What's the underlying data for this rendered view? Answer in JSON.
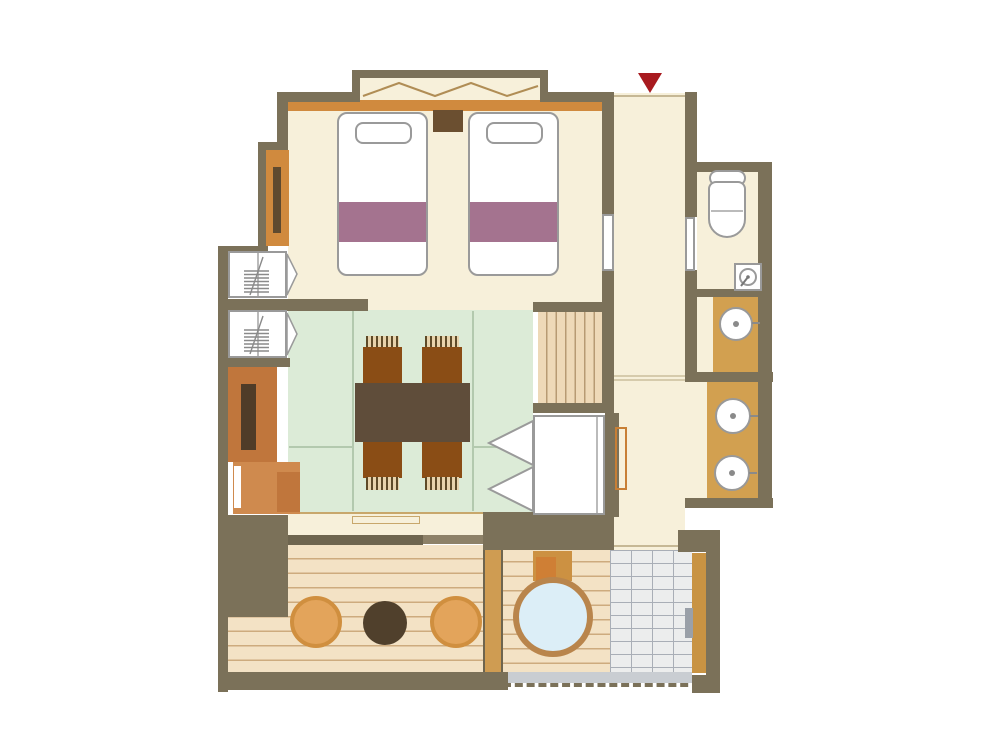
{
  "document": {
    "type": "floor-plan",
    "description": "Japanese-style hotel guest room floor plan with twin beds, tatami dining area, closets, toilet, vanities, changing area, wooden veranda and open-air round bath",
    "visible_text": []
  },
  "entrance_marker": {
    "shape": "downward-triangle",
    "color": "#a81a1f",
    "meaning": "entrance"
  },
  "rooms": [
    {
      "name": "bedroom",
      "floor": "cream",
      "contents": [
        "twin-bed-left",
        "twin-bed-right",
        "nightstand",
        "bay-window",
        "headboard-shelf",
        "wall-cabinet"
      ]
    },
    {
      "name": "tatami-dining-room",
      "floor": "tatami-green",
      "contents": [
        "low-table",
        "four-chairs"
      ]
    },
    {
      "name": "entrance-corridor",
      "floor": "cream",
      "contents": [
        "step-landing",
        "toilet-door",
        "bedroom-sliding-door"
      ]
    },
    {
      "name": "toilet-room",
      "floor": "cream",
      "contents": [
        "toilet",
        "corner-hand-basin"
      ]
    },
    {
      "name": "vanity-area-upper",
      "floor": "cream",
      "contents": [
        "counter-with-one-sink"
      ]
    },
    {
      "name": "changing-room",
      "floor": "cream",
      "contents": [
        "counter-with-two-sinks",
        "towel-rail"
      ]
    },
    {
      "name": "closet-wall",
      "contents": [
        "closet-with-hangers-1",
        "closet-with-hangers-2",
        "tv-cabinet",
        "low-cabinet",
        "folding-door-closet"
      ]
    },
    {
      "name": "veranda-deck",
      "floor": "wood-planks",
      "contents": [
        "stool-1",
        "round-tea-table",
        "stool-2"
      ]
    },
    {
      "name": "open-air-bath-terrace",
      "floor": "wood-planks",
      "contents": [
        "round-bathtub",
        "tub-step-box",
        "tiled-shower-area",
        "shower-fixture",
        "drain-gutter"
      ]
    }
  ],
  "furniture_counts": {
    "beds": 2,
    "dining_chairs": 4,
    "stools": 2,
    "sinks": 3,
    "toilets": 1,
    "bathtubs": 1,
    "closets": 3
  },
  "colors": {
    "wall": "#7b7159",
    "floor_cream": "#f7f0da",
    "tatami_green": "#dcebd7",
    "deck_wood": "#f3e2c5",
    "counter_tan": "#d2a050",
    "accent_orange": "#d08a3e",
    "cabinet_orange": "#c0763c",
    "blanket_plum": "#a4738f",
    "bath_water_blue": "#dceef7",
    "tub_rim": "#b9854c",
    "tile_grey": "#eceded",
    "entrance_red": "#a81a1f",
    "fixture_outline_grey": "#9a9a9a"
  }
}
